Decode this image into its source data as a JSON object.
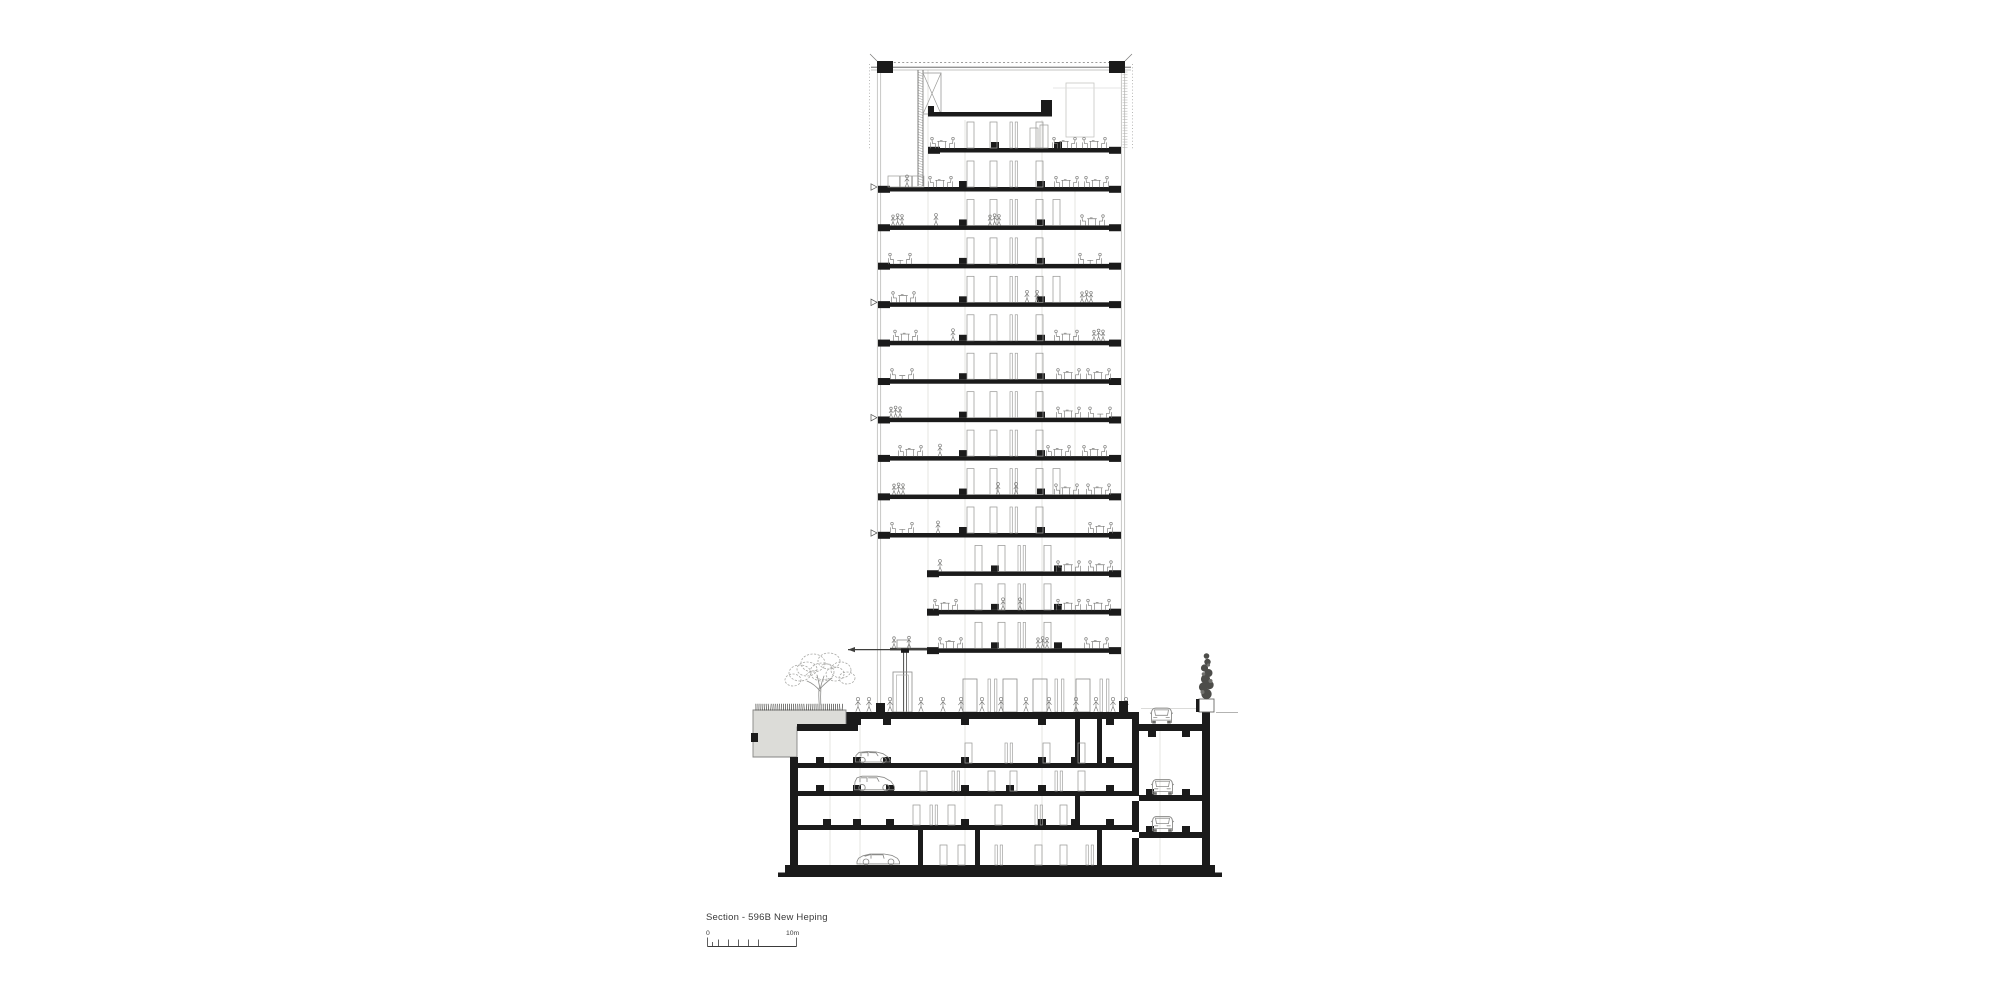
{
  "page": {
    "background_color": "#ffffff"
  },
  "title_block": {
    "title": "Section - 596B New Heping",
    "scale_bar": {
      "start_label": "0",
      "end_label": "10m"
    }
  },
  "drawing": {
    "kind": "architectural-building-section",
    "colors": {
      "ink": "#1b1b1b",
      "line_medium": "#6e6e6e",
      "line_light": "#b0b0ae",
      "line_faint": "#dededb",
      "concrete_fill": "#dcdcd8",
      "entourage": "#7b7b79",
      "foliage": "#a9a9a6",
      "shrub_dark": "#4d4d4a"
    },
    "tower": {
      "typical_floor_count": 10,
      "inset_floor_count": 3,
      "has_roof_mechanical_level": true,
      "facade_marker_count": 4
    },
    "ground": {
      "lobby": true,
      "green_roof_left": true,
      "tree_count": 1,
      "street_car_count": 1,
      "planter_shrub": true
    },
    "basement": {
      "level_count": 3,
      "parked_cars_side": 3,
      "ramp_cars_front": 2
    },
    "people": {
      "office_floor_groups": true,
      "lobby_standing_count": 14
    }
  }
}
